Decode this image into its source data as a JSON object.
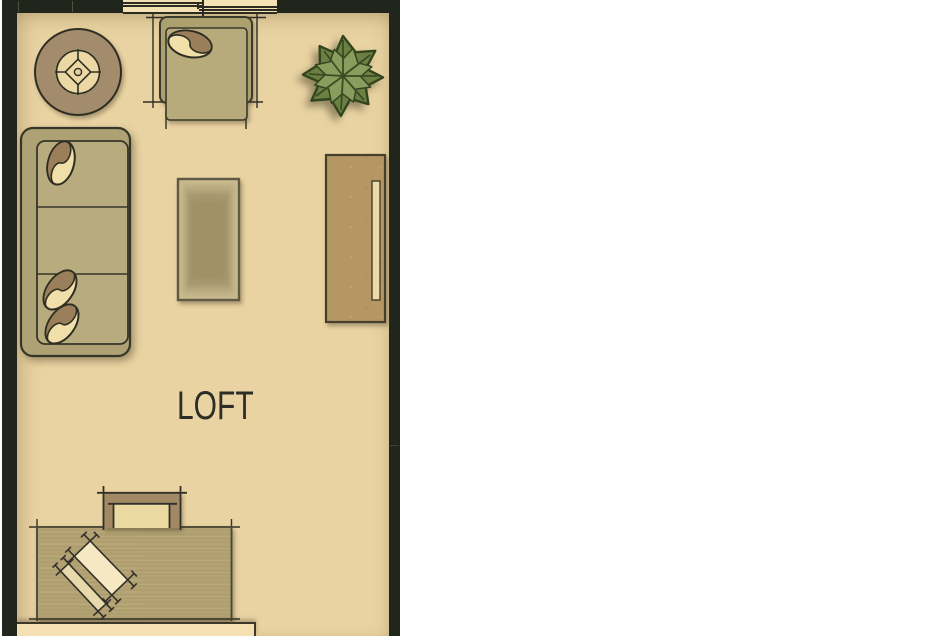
{
  "room": {
    "label": "LOFT"
  },
  "palette": {
    "background": "#ffffff",
    "floor": "#e9d3a2",
    "wall": "#21261c",
    "outline": "#32322a",
    "upholstery_frame": "#aca06f",
    "upholstery_seat": "#b8ab7d",
    "pillow_brown": "#9b7f5b",
    "pillow_cream": "#f0dfa8",
    "wood_desk": "#b3a274",
    "wood_sideboard": "#b49763",
    "plant_green_dark": "#6d8044",
    "plant_green_light": "#8a9c5e",
    "accent_cream": "#f4e0b3",
    "label_text": "#2b2d26"
  },
  "furniture": [
    {
      "id": "round-side-table"
    },
    {
      "id": "armchair"
    },
    {
      "id": "potted-plant"
    },
    {
      "id": "sofa"
    },
    {
      "id": "coffee-table"
    },
    {
      "id": "sideboard"
    },
    {
      "id": "desk"
    },
    {
      "id": "desk-chair"
    },
    {
      "id": "paper-sheet"
    },
    {
      "id": "pen-tray"
    },
    {
      "id": "window"
    },
    {
      "id": "ledge"
    }
  ]
}
